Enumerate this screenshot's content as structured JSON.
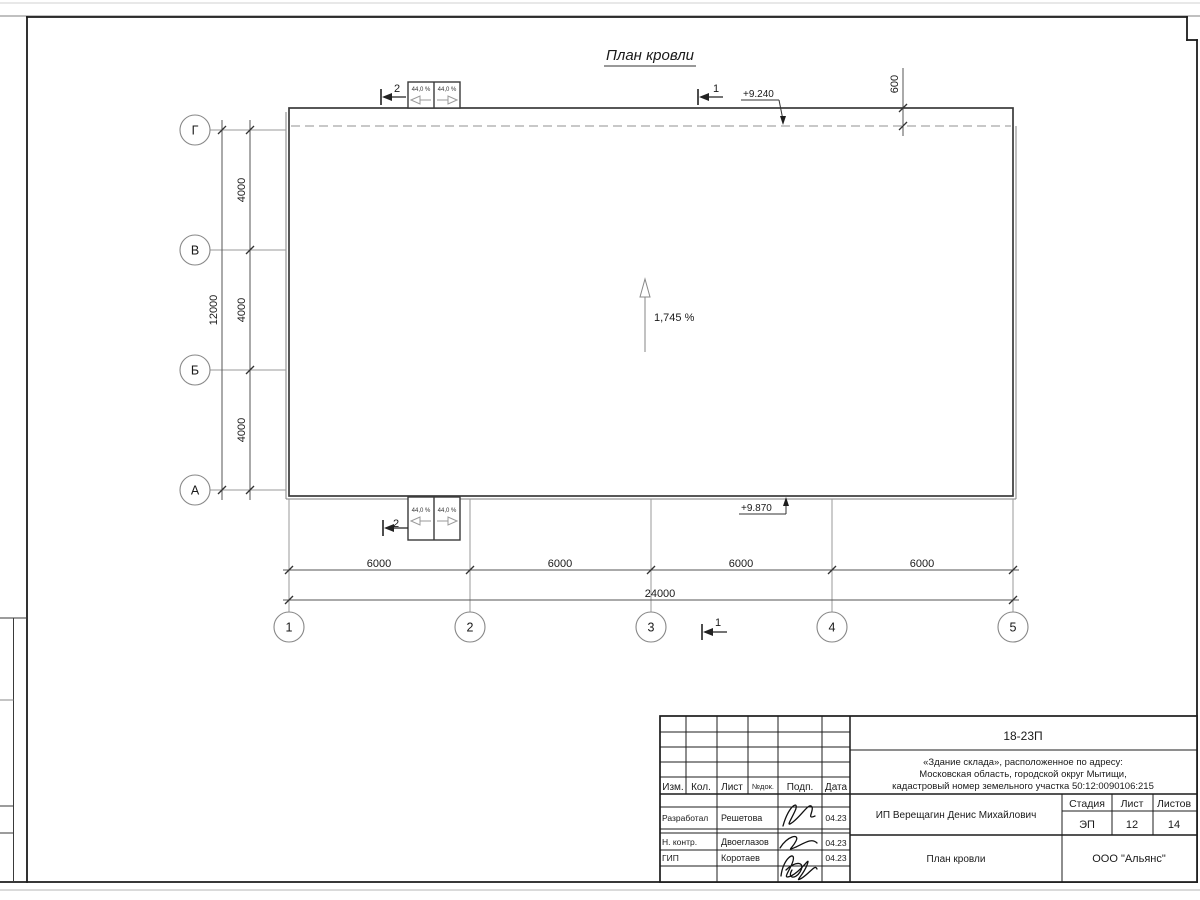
{
  "sheet": {
    "title": "План кровли"
  },
  "axes": {
    "rows": [
      "Г",
      "В",
      "Б",
      "А"
    ],
    "cols": [
      "1",
      "2",
      "3",
      "4",
      "5"
    ]
  },
  "dimensions": {
    "row_segments": [
      "4000",
      "4000",
      "4000"
    ],
    "row_total": "12000",
    "col_segments": [
      "6000",
      "6000",
      "6000",
      "6000"
    ],
    "col_total": "24000",
    "roof_offset": "600"
  },
  "annotations": {
    "elevation_top": "+9.240",
    "elevation_bottom": "+9.870",
    "main_slope": "1,745 %",
    "canopy_slope": "44,0 %",
    "section_mark_1": "1",
    "section_mark_2": "2"
  },
  "title_block": {
    "doc_number": "18-23П",
    "project_lines": [
      "«Здание склада», расположенное по адресу:",
      "Московская область, городской округ Мытищи,",
      "кадастровый номер земельного участка 50:12:0090106:215"
    ],
    "client": "ИП Верещагин Денис Михайлович",
    "drawing_title": "План кровли",
    "company": "ООО \"Альянс\"",
    "headers": {
      "izm": "Изм.",
      "kol": "Кол.",
      "list": "Лист",
      "ndok": "№док.",
      "podp": "Подп.",
      "data": "Дата"
    },
    "stage_label": "Стадия",
    "sheet_label": "Лист",
    "sheets_label": "Листов",
    "stage": "ЭП",
    "sheet_no": "12",
    "sheets_total": "14",
    "roles": [
      {
        "role": "Разработал",
        "name": "Решетова",
        "date": "04.23"
      },
      {
        "role": "Н. контр.",
        "name": "Двоеглазов",
        "date": "04.23"
      },
      {
        "role": "ГИП",
        "name": "Коротаев",
        "date": "04.23"
      }
    ]
  },
  "colors": {
    "line_dark": "#1c1c1c",
    "line_medium": "#555555",
    "line_light": "#9a9a9a",
    "dashed_line": "#b5b5b5",
    "paper": "#ffffff"
  }
}
